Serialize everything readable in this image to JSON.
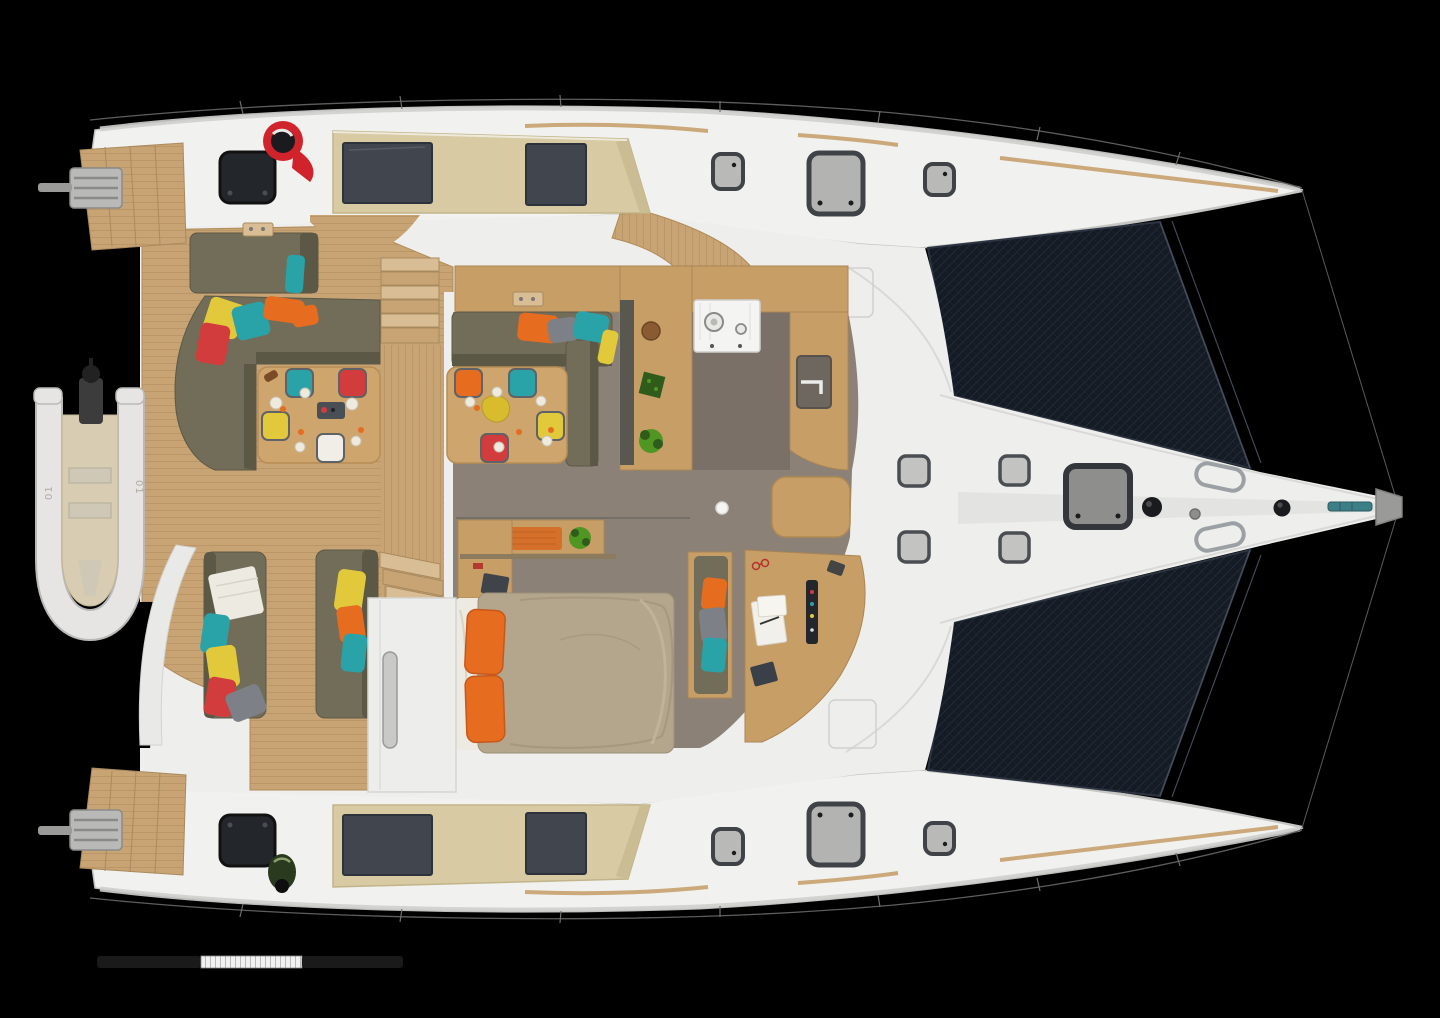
{
  "meta": {
    "title": "Catamaran deck layout - top view 3D render",
    "type": "boat-deck-plan",
    "canvas": {
      "width": 1440,
      "height": 1018
    },
    "orientation": "bow-to-the-right"
  },
  "colors": {
    "background": "#000000",
    "hull": "#f1f1ef",
    "hull_edge": "#c2c2c0",
    "deck": "#eeeeec",
    "deck_line": "#d9d9d7",
    "teak": "#c8a474",
    "teak_line": "#ab8554",
    "teak_light": "#d9bd94",
    "roof": "#d8cba3",
    "roof_edge": "#c2b488",
    "glass": "#41464e",
    "tramp": "#151b25",
    "tramp_line": "#2c3442",
    "floor": "#8b8177",
    "floor_dark": "#7a7067",
    "counter": "#c79e66",
    "counter_dark": "#585850",
    "sofa": "#716d58",
    "sofa_dark": "#5c5846",
    "table": "#cda56d",
    "duvet": "#b3a68c",
    "linen": "#edeae1",
    "red": "#d23c3c",
    "yellow": "#e2c93c",
    "teal": "#2aa3a8",
    "orange": "#e66c20",
    "gray_pillow": "#7d8187",
    "white_pillow": "#f0eee6",
    "stove": "#f4f4f2",
    "plant": "#4f9623",
    "plant_dark": "#2f5c1a",
    "dinghy": "#e6e5e3",
    "dinghy_floor": "#d8ccb2",
    "metal": "#9aa0a4",
    "dark_fitting": "#1a1b1e",
    "winch_red": "#d0232b",
    "winch_green": "#2a3a1e",
    "scale_dark": "#1a1a1a",
    "scale_light": "#f2f2f2"
  },
  "dinghy": {
    "marking": "01"
  },
  "features": [
    "starboard-hull",
    "port-hull",
    "starboard-trampoline",
    "port-trampoline",
    "bowsprit",
    "foredeck",
    "starboard-coachroof",
    "port-coachroof",
    "cockpit",
    "aft-platform",
    "dinghy",
    "galley",
    "saloon",
    "cockpit-dining-table",
    "saloon-dining-table",
    "master-bed",
    "nav-desk",
    "daybeds",
    "stern-steps",
    "scale-bar"
  ]
}
